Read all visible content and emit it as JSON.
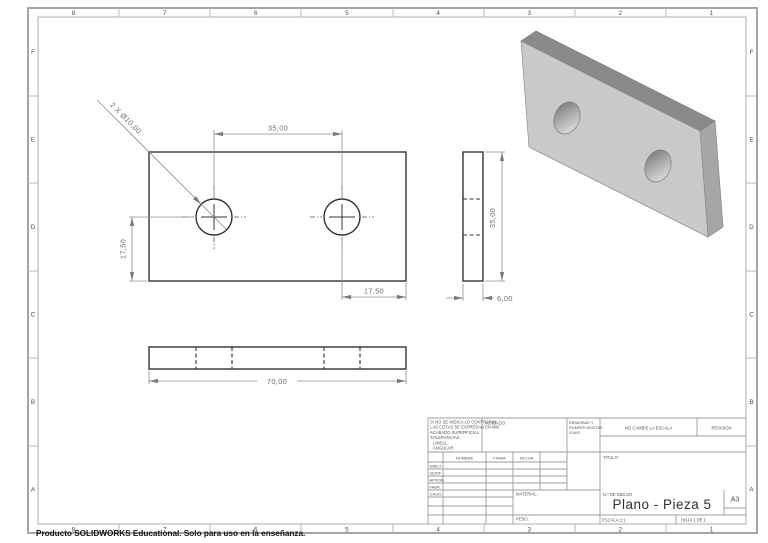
{
  "sheet": {
    "zone_columns": [
      "8",
      "7",
      "6",
      "5",
      "4",
      "3",
      "2",
      "1"
    ],
    "zone_rows": [
      "F",
      "E",
      "D",
      "C",
      "B",
      "A"
    ],
    "footer_note": "Producto SOLIDWORKS Educational. Solo para uso en la enseñanza."
  },
  "drawing": {
    "front_view": {
      "hole_callout": "2 X Ø10,00",
      "hole_spacing_dim": "35,00",
      "left_height_dim": "17,50",
      "right_offset_dim": "17,50"
    },
    "side_view": {
      "height_dim": "35,00",
      "thickness_dim": "6,00"
    },
    "bottom_view": {
      "length_dim": "70,00"
    }
  },
  "title_block": {
    "general_notes": [
      "SI NO SE INDICA LO CONTRARIO:",
      "LAS COTAS SE EXPRESAN EN MM",
      "ACABADO SUPERFICIAL:",
      "TOLERANCIAS:",
      "LINEAL:",
      "ANGULAR:"
    ],
    "finish_label": "ACABADO:",
    "deburr_note": [
      "REBARBAR Y",
      "ROMPER ARISTAS",
      "VIVAS"
    ],
    "no_scale_note": "NO CAMBIE LA ESCALA",
    "revision_label": "REVISIÓN",
    "sign_columns": [
      "NOMBRE",
      "FIRMA",
      "FECHA"
    ],
    "sign_rows": [
      "DIBUJ.",
      "VERIF.",
      "APROB.",
      "FABR.",
      "CALID."
    ],
    "material_label": "MATERIAL:",
    "weight_label": "PESO:",
    "title_label": "TÍTULO:",
    "drawing_number_label": "N.º DE DIBUJO",
    "drawing_title": "Plano - Pieza 5",
    "sheet_format": "A3",
    "scale_label": "ESCALA:1:1",
    "sheet_label": "HOJA 1 DE 1"
  },
  "colors": {
    "drawing_line": "#333333",
    "dimension": "#6f6f6f",
    "border": "#9b9b9b",
    "iso_front_face": "#c9c9c9",
    "iso_top_face": "#8a8a8a",
    "iso_right_face": "#a6a6a6"
  }
}
